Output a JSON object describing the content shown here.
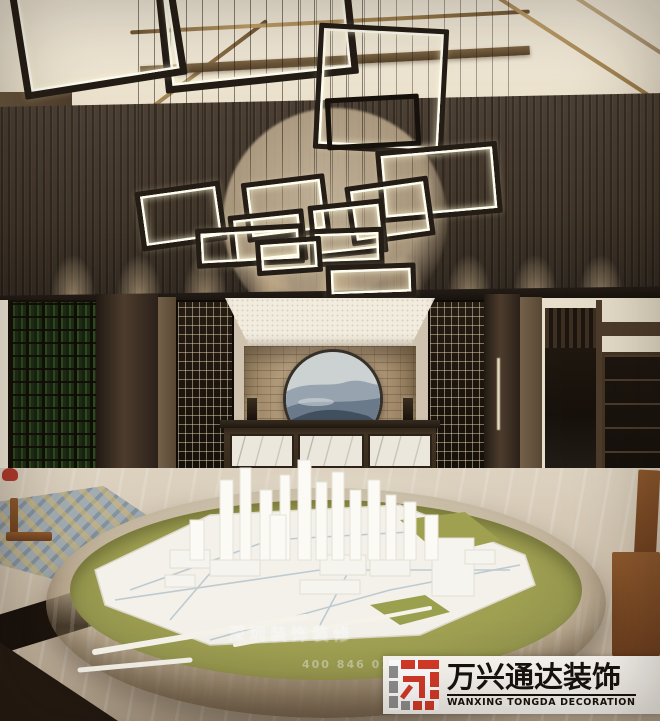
{
  "brand": {
    "name_cn": "万兴通达装饰",
    "name_en": "WANXING TONGDA DECORATION",
    "logo_red": "#d43a28",
    "logo_gray": "#8f8f8f"
  },
  "watermark": {
    "text": "深圳装饰装修",
    "phone": "400 846 0163"
  },
  "palette": {
    "wood_dark": "#3a2f26",
    "ceiling_cream": "#efe7d6",
    "brass_trim": "#b3945f",
    "stone_wall": "#b19a79",
    "marble_floor": "#cfc2ae",
    "model_table_green": "#9b9c4f",
    "model_white": "#f3f1e9",
    "artwork_blue": "#5a6878"
  }
}
